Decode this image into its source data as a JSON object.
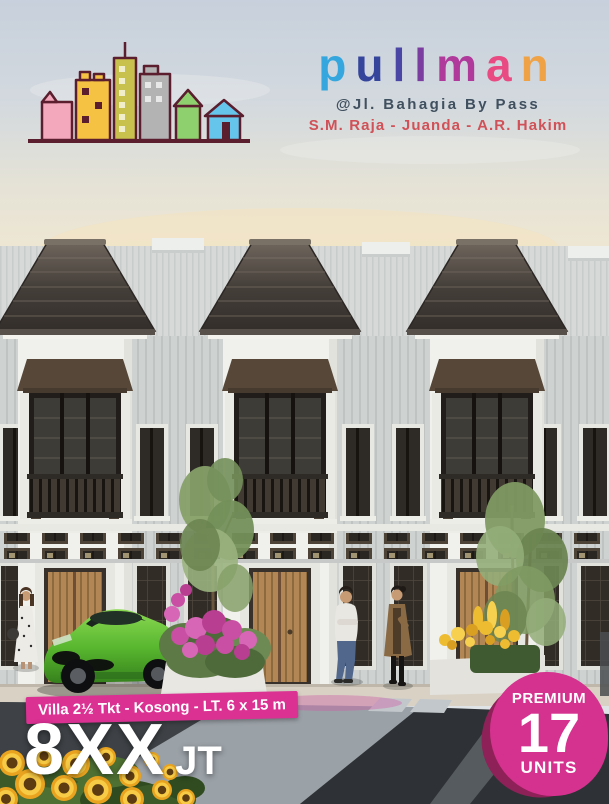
{
  "brand": {
    "letters": [
      {
        "char": "p",
        "color": "#35a7de"
      },
      {
        "char": "u",
        "color": "#35459c"
      },
      {
        "char": "l",
        "color": "#4a46a5"
      },
      {
        "char": "l",
        "color": "#7b3da0"
      },
      {
        "char": "m",
        "color": "#b0399c"
      },
      {
        "char": "a",
        "color": "#e94a82"
      },
      {
        "char": "n",
        "color": "#f0a246"
      }
    ],
    "location": "@Jl. Bahagia By Pass",
    "roads": "S.M. Raja - Juanda - A.R. Hakim"
  },
  "colors": {
    "location_text": "#41505f",
    "roads_text": "#d05157",
    "banner_bg": "#da3193",
    "badge_bg": "#d5318e",
    "badge_shadow": "#8e2158"
  },
  "offer": {
    "spec": "Villa 2½ Tkt - Kosong - LT. 6 x 15 m",
    "price": "8XX",
    "unit": "JT"
  },
  "badge": {
    "line1": "PREMIUM",
    "number": "17",
    "line2": "UNITS"
  }
}
